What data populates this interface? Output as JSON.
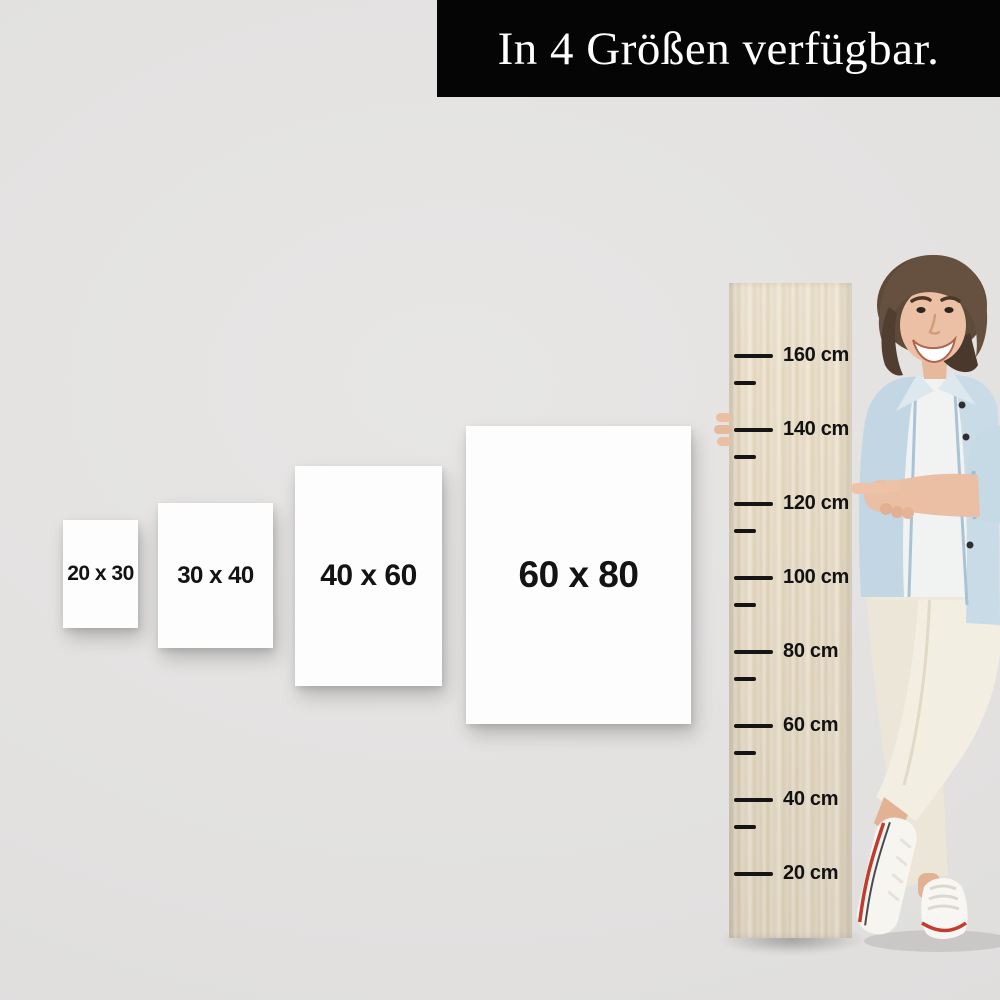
{
  "banner": {
    "text": "In 4 Größen verfügbar."
  },
  "posters": [
    {
      "label": "20 x 30"
    },
    {
      "label": "30 x 40"
    },
    {
      "label": "40 x 60"
    },
    {
      "label": "60 x 80"
    }
  ],
  "ruler": {
    "unit": "cm",
    "tick_labels": [
      "160 cm",
      "140 cm",
      "120 cm",
      "100 cm",
      "80 cm",
      "60 cm",
      "40 cm",
      "20 cm"
    ],
    "pointed_at": "120 cm"
  },
  "photo": {
    "subject": "smiling woman with short brown hair wearing a light denim jacket, white t-shirt, cream pants and white sneakers, leaning on a wooden height ruler and pointing at the 120 cm mark"
  },
  "colors": {
    "background": "#e2e1e0",
    "banner_bg": "#050505",
    "banner_fg": "#ffffff",
    "poster_bg": "#fdfdfd",
    "label_fg": "#131313",
    "tick_fg": "#151515",
    "wood_light": "#f1e9da",
    "wood_dark": "#e0d2b8",
    "denim": "#c6dae6",
    "skin": "#ecc0a4",
    "hair": "#5f4939",
    "pants": "#f1ece0",
    "sneaker_stripe_red": "#c23b2f"
  }
}
